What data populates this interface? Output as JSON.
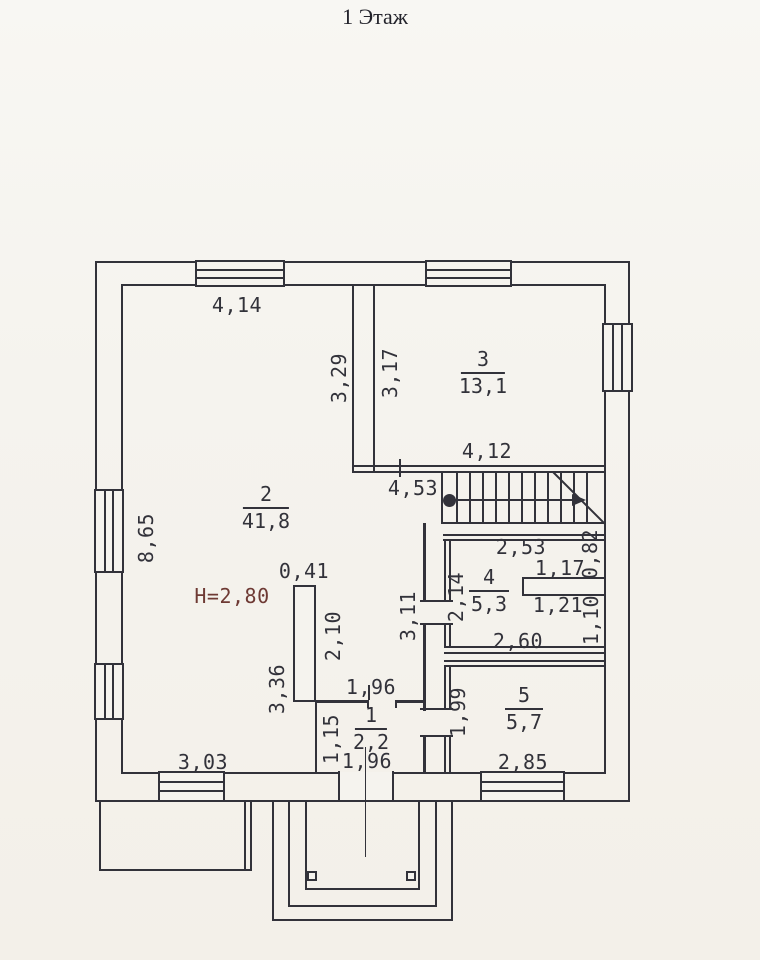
{
  "title": "1 Этаж",
  "height_note": "Н=2,80",
  "rooms": {
    "r1": {
      "number": "1",
      "area": "2,2"
    },
    "r2": {
      "number": "2",
      "area": "41,8"
    },
    "r3": {
      "number": "3",
      "area": "13,1"
    },
    "r4": {
      "number": "4",
      "area": "5,3"
    },
    "r5": {
      "number": "5",
      "area": "5,7"
    }
  },
  "dims": {
    "room2_top": "4,14",
    "room2_left": "8,65",
    "room2_bottom": "3,03",
    "room2_right_upper": "3,29",
    "room2_right_lower": "3,36",
    "room3_left": "3,17",
    "room3_bottom": "4,12",
    "stair_hall_width": "4,53",
    "partition_thickness": "0,41",
    "partition_length": "2,10",
    "hall_right": "3,11",
    "room4_top": "2,53",
    "room4_left": "2,14",
    "room4_bottom": "2,60",
    "niche_top_width": "1,17",
    "niche_top_height": "0,82",
    "niche_bottom_width": "1,21",
    "niche_bottom_height": "1,10",
    "room1_top": "1,96",
    "room1_bottom": "1,96",
    "room1_left": "1,15",
    "room5_left": "1,99",
    "room5_bottom": "2,85"
  },
  "colors": {
    "ink": "#32323a",
    "background": "#f5f3ee",
    "height_note": "#6e3a34"
  }
}
